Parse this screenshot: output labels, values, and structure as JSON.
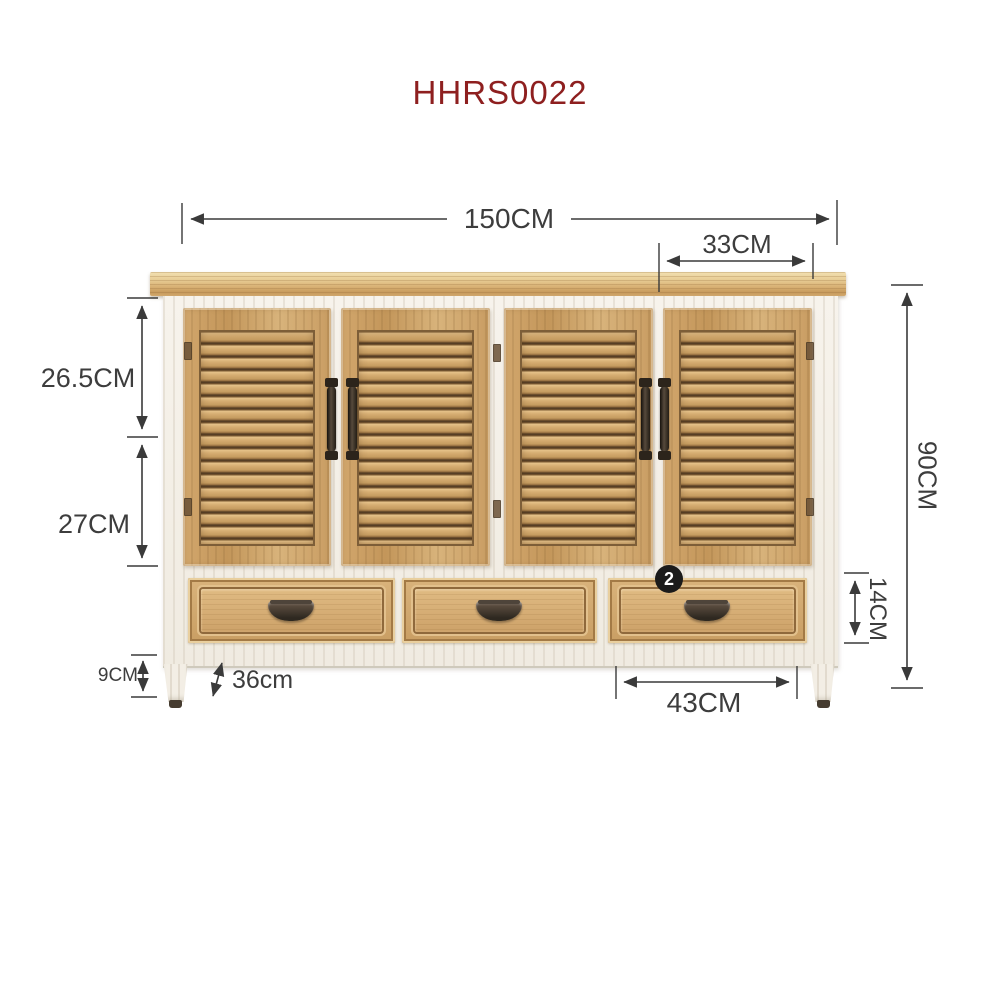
{
  "title": "HHRS0022",
  "colors": {
    "title_text": "#8e1f1f",
    "dimension_lines": "#3a3a3a",
    "dimension_text": "#3d3d3d",
    "badge_background": "#1b1b1b",
    "badge_text": "#ffffff",
    "wood": "#d2a76d",
    "frame_white": "#f5f1e9"
  },
  "dims": {
    "total_width": "150CM",
    "right_door_width": "33CM",
    "upper_door_height": "26.5CM",
    "lower_door_height": "27CM",
    "total_height": "90CM",
    "drawer_height": "14CM",
    "drawer_width": "43CM",
    "leg_height": "9CM",
    "depth": "36cm"
  },
  "badge": {
    "label": "2"
  }
}
